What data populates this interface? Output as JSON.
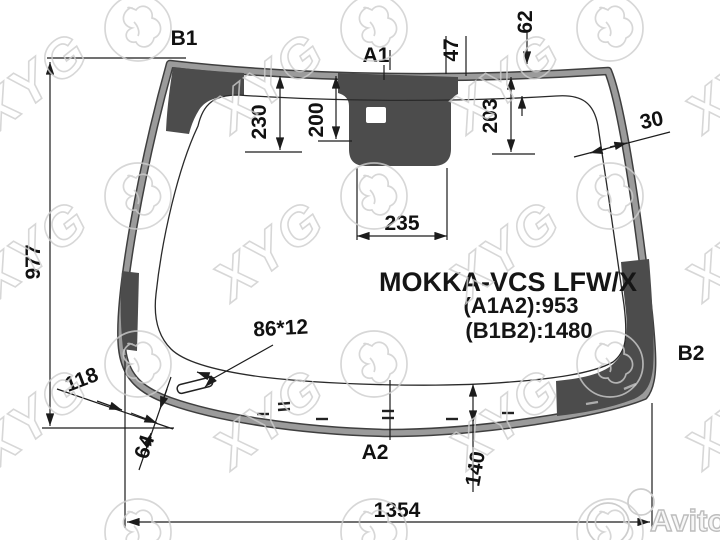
{
  "title_block": {
    "model": "MOKKA-VCS LFW/X",
    "a1a2": "(A1A2):953",
    "b1b2": "(B1B2):1480"
  },
  "labels": {
    "b1": "B1",
    "a1": "A1",
    "b2": "B2",
    "a2": "A2"
  },
  "dimensions": {
    "left_height": "977",
    "band_230": "230",
    "band_200": "200",
    "sensor_width": "235",
    "band_203": "203",
    "offset_47": "47",
    "edge_62": "62",
    "edge_30": "30",
    "corner_118": "118",
    "corner_64": "64",
    "slot": "86*12",
    "bottom_band": "140",
    "bottom_width": "1354"
  },
  "watermarks": {
    "brand": "XYG",
    "marketplace": "Avito"
  },
  "colors": {
    "frit_dark": "#4c4c4c",
    "rim_gray": "#9b9b9b",
    "line": "#1c1c1c",
    "watermark": "#cdcdcd"
  }
}
